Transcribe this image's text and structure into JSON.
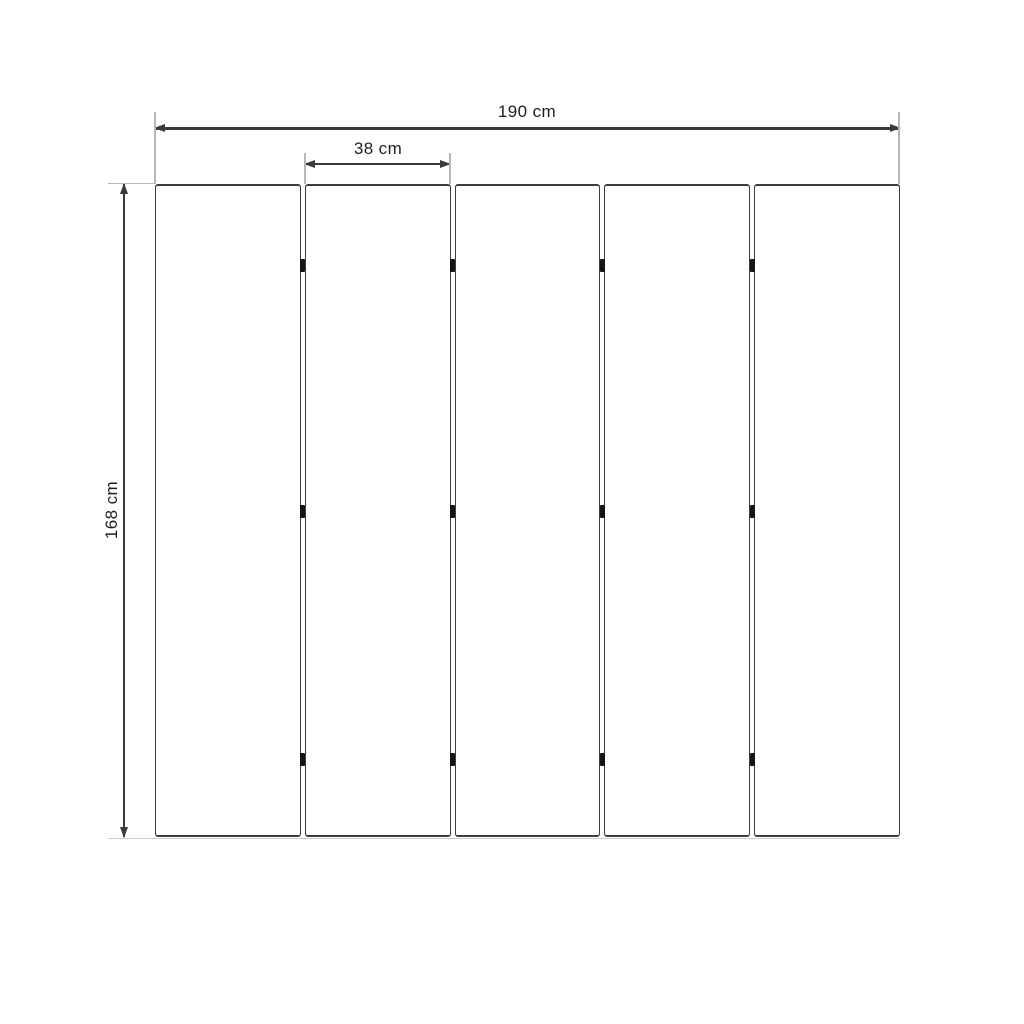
{
  "diagram": {
    "type": "dimension-drawing",
    "panel_count": 5,
    "hinges_per_gap": 3,
    "dimensions": {
      "total_width": "190 cm",
      "panel_width": "38 cm",
      "height": "168 cm"
    },
    "colors": {
      "background": "#ffffff",
      "panel_fill": "#ffffff",
      "panel_border": "#3d3d3d",
      "dimension_line": "#3a3a3a",
      "extension_line": "#b7b7b7",
      "hinge": "#151515",
      "label_text": "#1f1f1f"
    }
  }
}
